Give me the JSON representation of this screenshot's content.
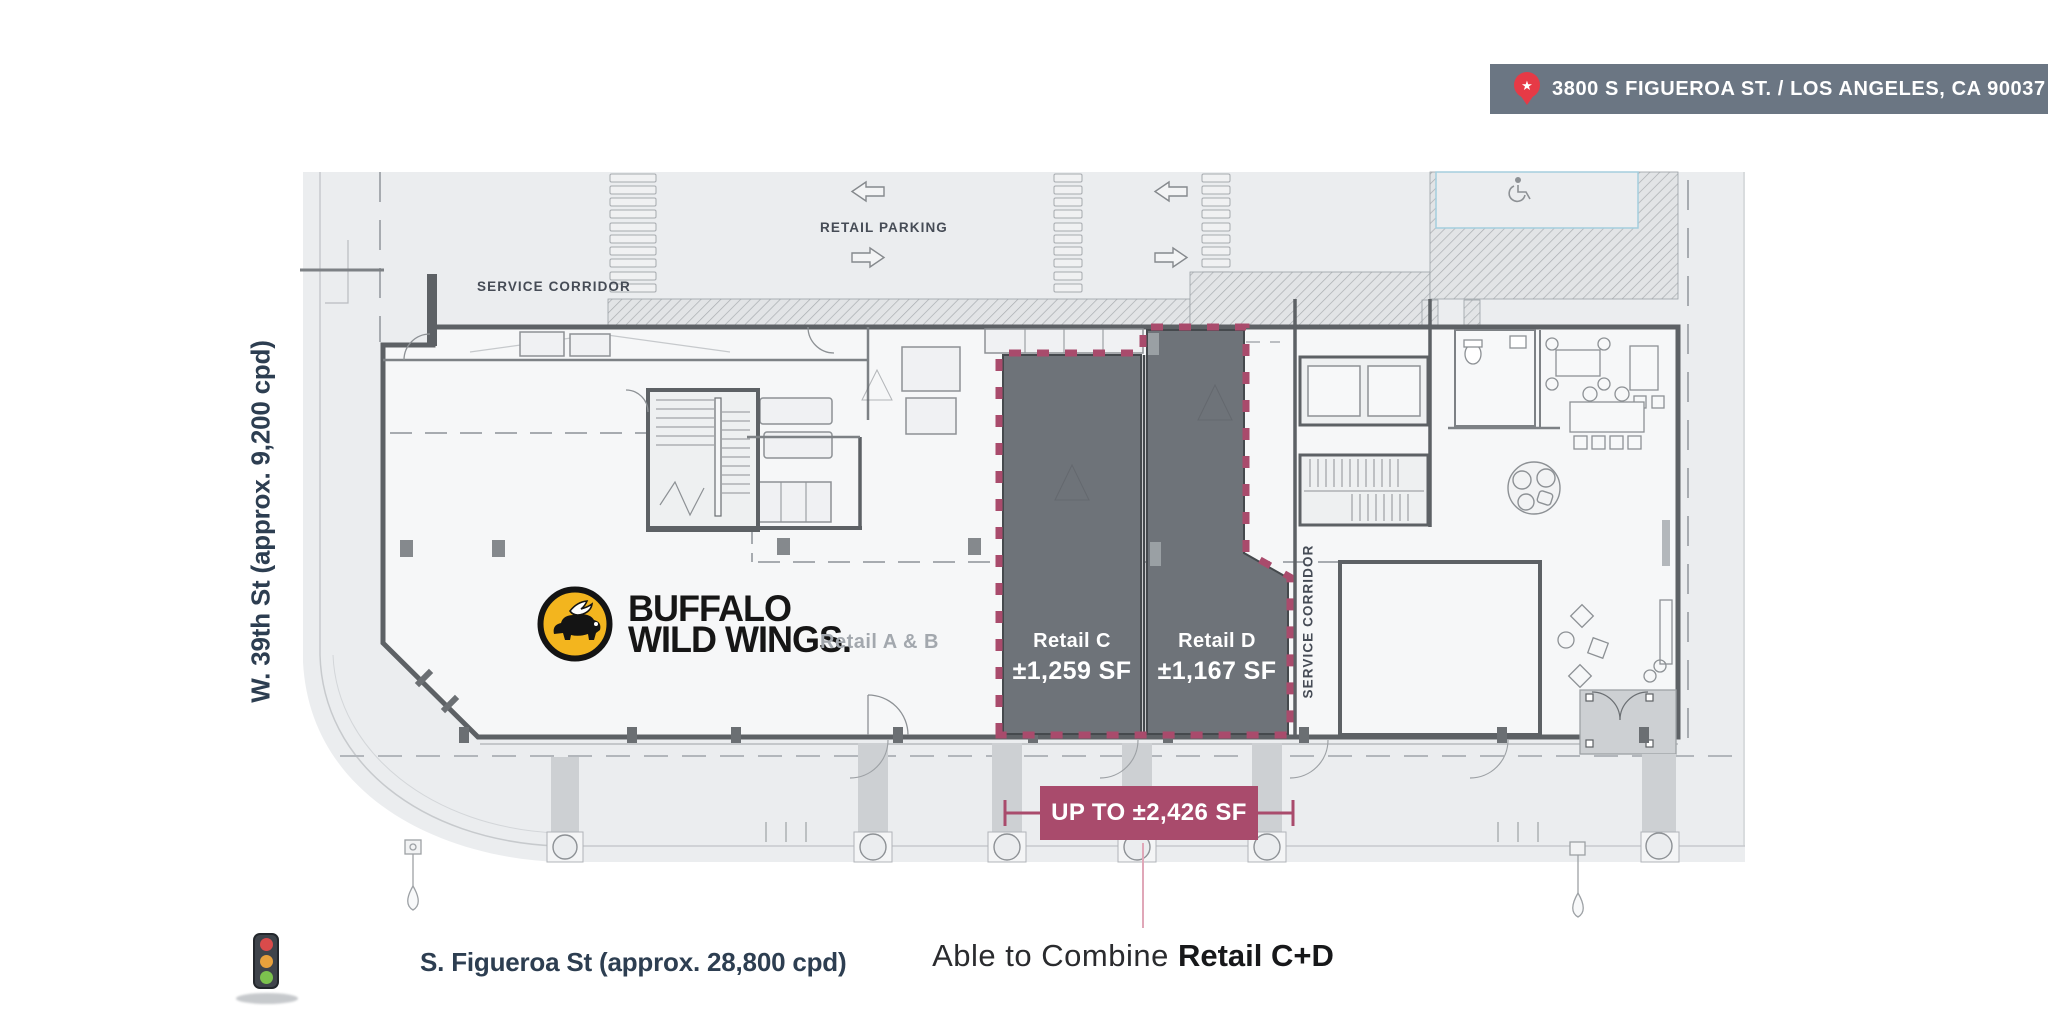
{
  "address_banner": {
    "text": "3800 S FIGUEROA ST. / LOS ANGELES, CA 90037"
  },
  "plan_labels": {
    "retail_parking": "RETAIL PARKING",
    "service_corridor_top": "SERVICE CORRIDOR",
    "service_corridor_right": "SERVICE CORRIDOR"
  },
  "tenant": {
    "logo_line1": "BUFFALO",
    "logo_line2": "WILD WINGS.",
    "suite_label": "Retail A & B"
  },
  "suites": {
    "c": {
      "name": "Retail C",
      "area": "±1,259 SF"
    },
    "d": {
      "name": "Retail D",
      "area": "±1,167 SF"
    }
  },
  "availability_banner": {
    "text": "UP TO ±2,426 SF"
  },
  "combine_note": {
    "prefix": "Able to Combine ",
    "bold": "Retail C+D"
  },
  "streets": {
    "west": "W. 39th St (approx. 9,200 cpd)",
    "south": "S. Figueroa St (approx. 28,800 cpd)"
  },
  "icons": {
    "pin": "location-pin",
    "pin_glyph": "★",
    "traffic_light": "traffic-light",
    "accessible_parking": "accessible-parking"
  },
  "colors": {
    "accent_magenta": "#a94b6c",
    "suite_gray": "#6e7379",
    "banner_slate": "#6b7683",
    "pin_red": "#e63a46",
    "logo_yellow": "#f3b51e",
    "street_navy": "#2d3e51"
  }
}
